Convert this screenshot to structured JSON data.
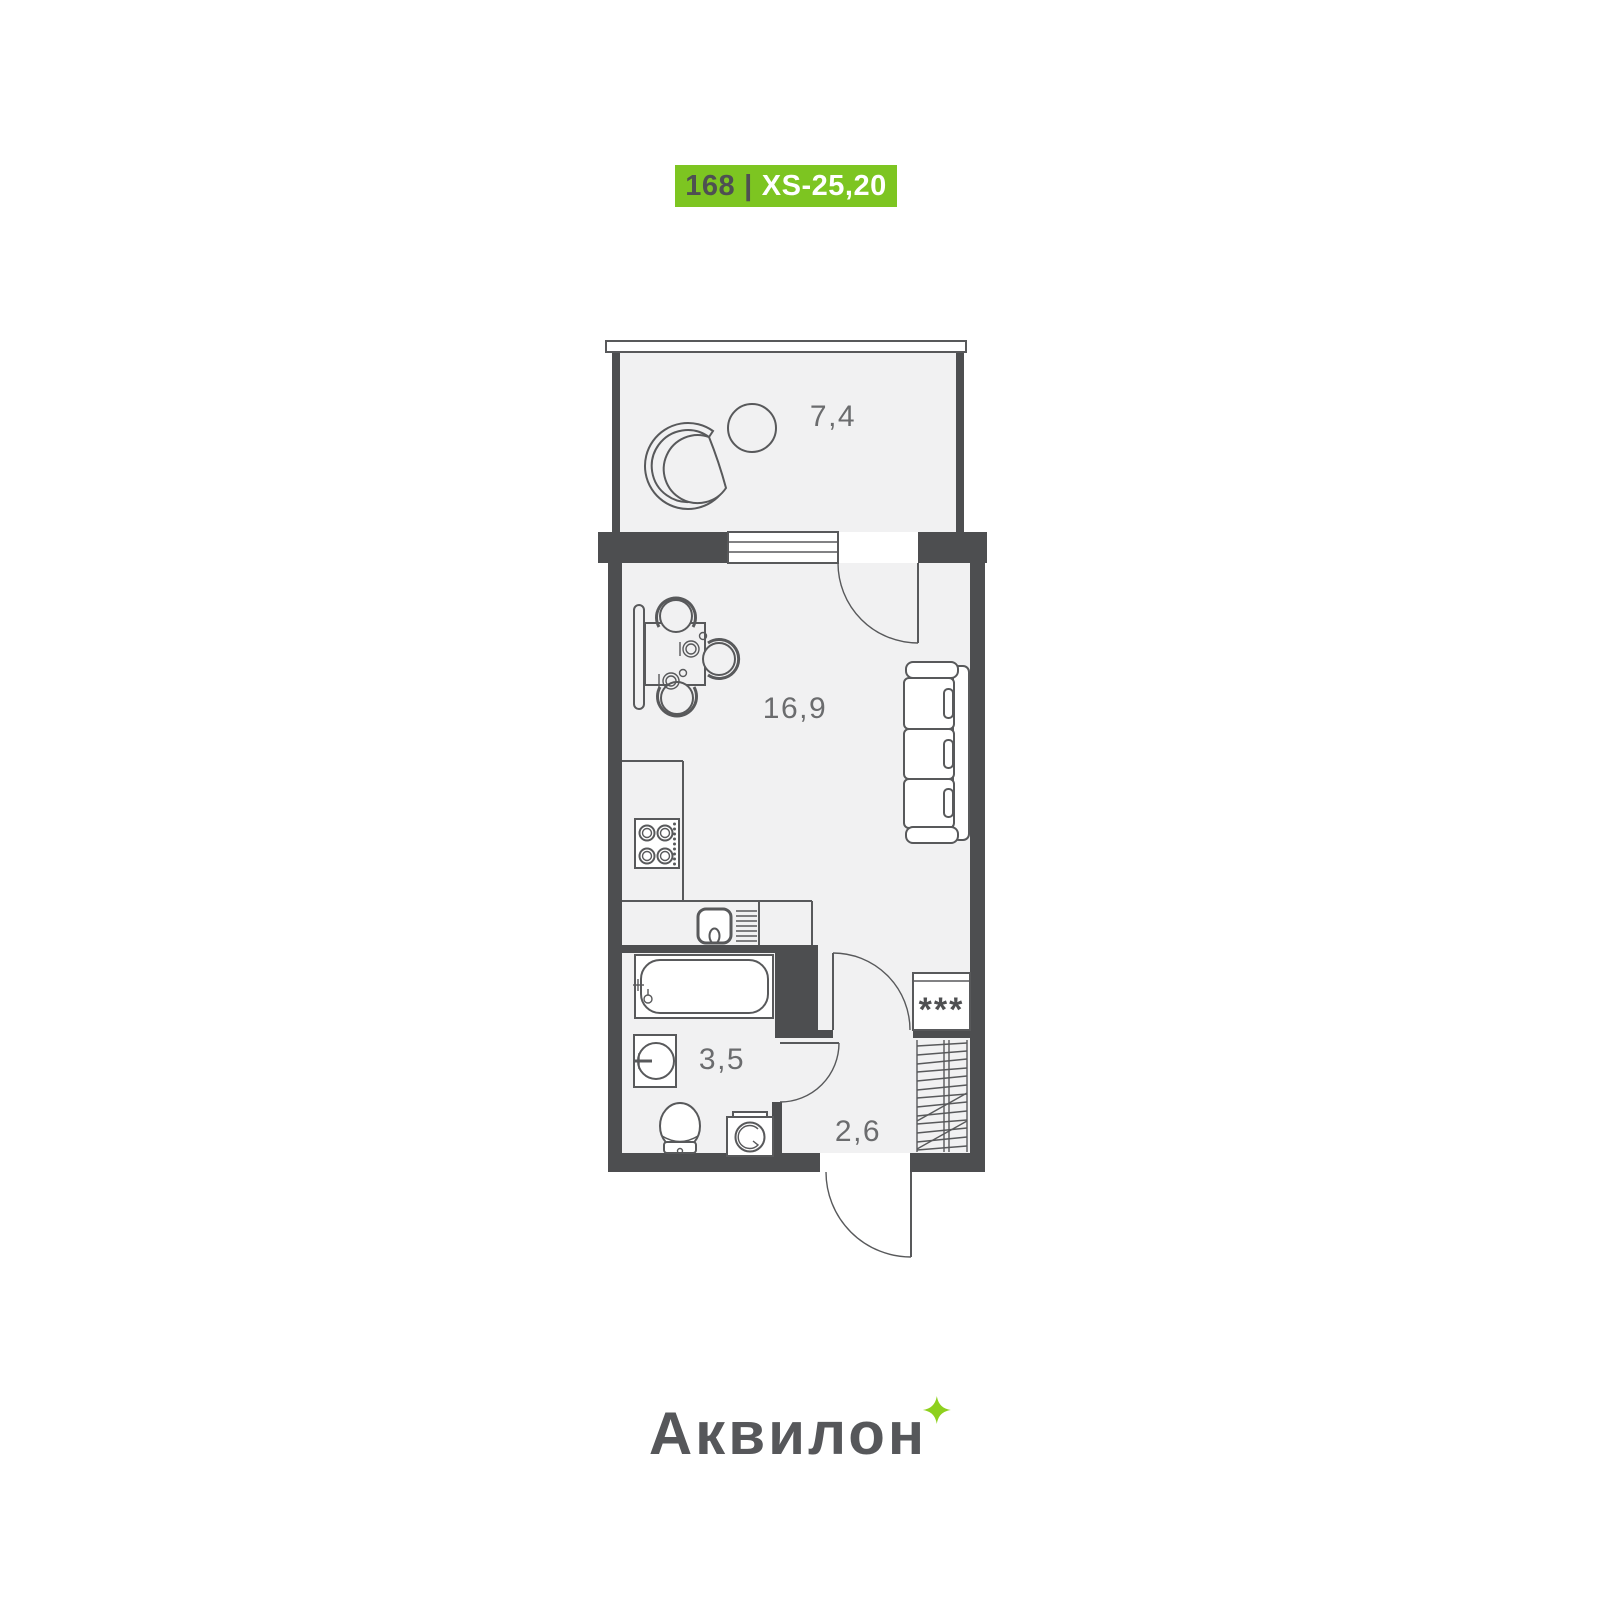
{
  "badge": {
    "unit_number": "168",
    "separator": "|",
    "plan_type": "XS-25,20",
    "background_color": "#7dc521",
    "number_color": "#4e5052",
    "type_color": "#ffffff"
  },
  "plan": {
    "rooms": [
      {
        "name": "balcony",
        "area": "7,4"
      },
      {
        "name": "living-room",
        "area": "16,9"
      },
      {
        "name": "bathroom",
        "area": "3,5"
      },
      {
        "name": "hallway",
        "area": "2,6"
      }
    ],
    "wardrobe_label": "***",
    "colors": {
      "walls": "#4d4e50",
      "furniture_lines": "#58595b",
      "floor": "#f1f1f2",
      "labels": "#6b6c6e"
    }
  },
  "footer": {
    "brand": "Аквилон",
    "brand_color": "#56575a",
    "sparkle_color": "#8ed01e"
  }
}
